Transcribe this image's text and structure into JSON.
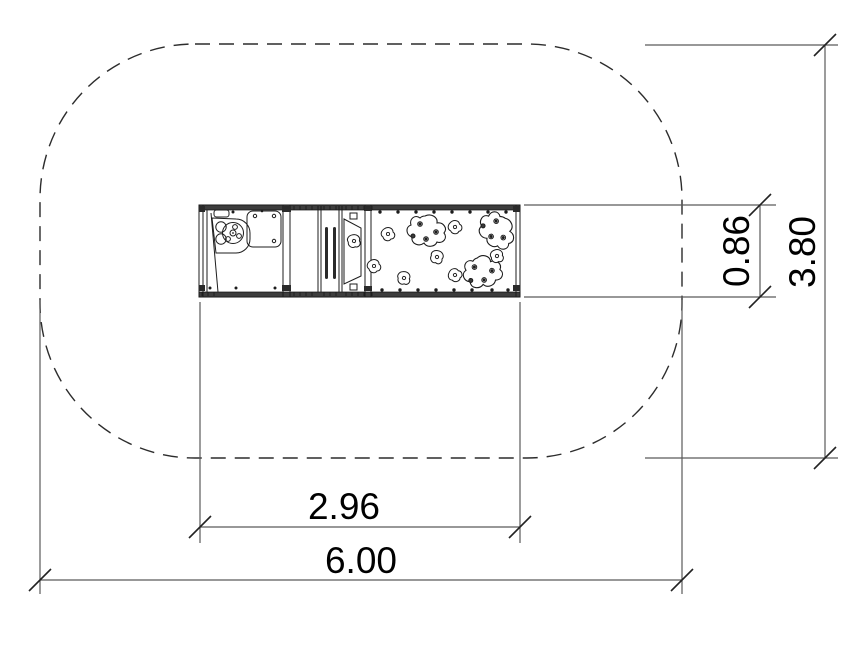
{
  "drawing": {
    "dimensions": {
      "equipment_width": "2.96",
      "total_width": "6.00",
      "equipment_depth": "0.86",
      "total_depth": "3.80"
    },
    "colors": {
      "background": "#ffffff",
      "dimension_line": "#5a5a5a",
      "dimension_text": "#000000",
      "equipment_line": "#1c1c1c",
      "safety_boundary": "#2c2c2c"
    }
  }
}
